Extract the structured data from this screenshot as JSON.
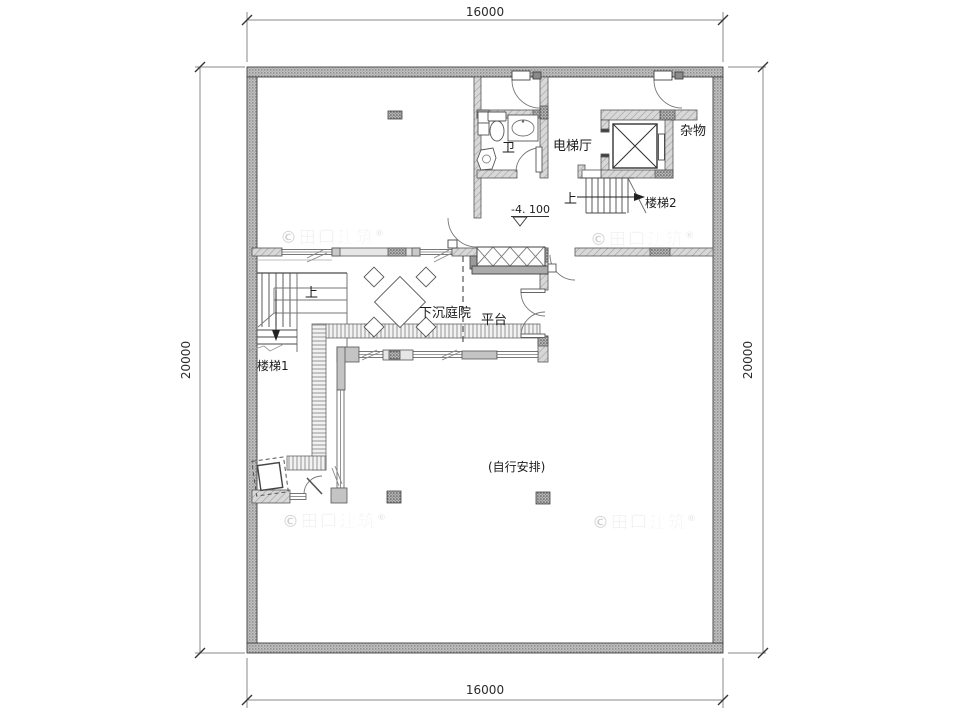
{
  "drawing": {
    "dim": {
      "top": "16000",
      "bottom": "16000",
      "left": "20000",
      "right": "20000"
    },
    "rooms": {
      "bathroom": "卫",
      "elevator_hall": "电梯厅",
      "storage": "杂物",
      "sunken_courtyard": "下沉庭院",
      "platform": "平台"
    },
    "stairs": {
      "stair1": "楼梯1",
      "stair2": "楼梯2",
      "up": "上"
    },
    "elevation": "-4. 100",
    "note_self_arrange": "(自行安排)",
    "watermark": {
      "text": "©田口建筑",
      "reg": "®"
    },
    "colors": {
      "exterior_wall": "#c2c2c2",
      "interior_wall": "#d8d8d8",
      "line": "#3a3a3a"
    }
  }
}
